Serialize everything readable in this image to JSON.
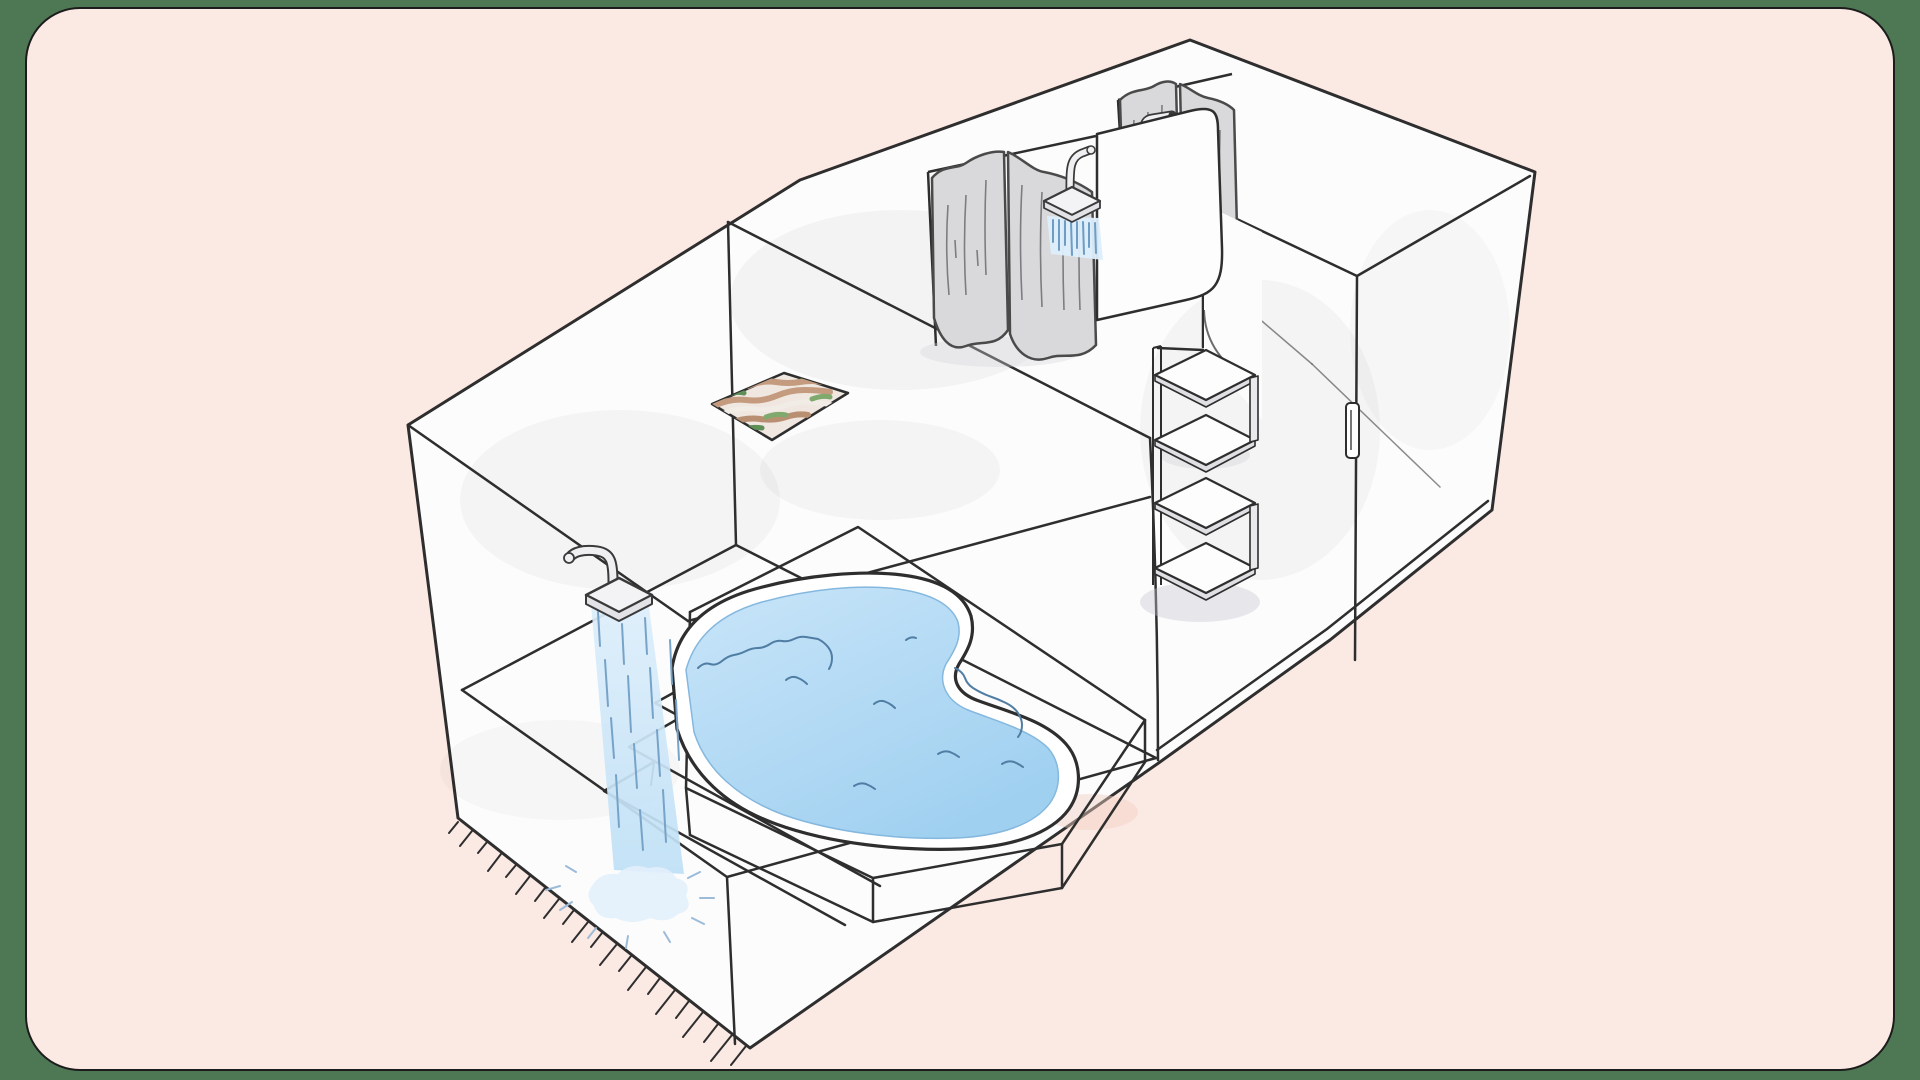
{
  "palette": {
    "outer_bg": "#4d7853",
    "card_bg": "#fbe9e4",
    "card_border": "#1c1c1c",
    "line": "#2e2e2e",
    "wall": "#fcfcfd",
    "water": "#9fd0f0",
    "water_light": "#c9e5f9",
    "water_edge": "#85b8de",
    "stream_top": "#ddeefb",
    "stream_bottom": "#bfe0f6",
    "stream_line": "#77a3c8",
    "wave_line": "#4f7da3",
    "splash_fill": "#e2f0fb",
    "splash_line": "#9cbbd8",
    "curtain_fill": "#d9d9db",
    "curtain_line": "#4a4a4a",
    "curtain_crease": "#7d7d80",
    "fixture_fill": "#f0f0f2",
    "fixture_face": "#f3f3f5",
    "fixture_lip": "#e3e3e7",
    "fixture_line": "#3a3a3a",
    "mat_fill": "#4e4e4e",
    "mosaic_tan": "#c49b7e",
    "mosaic_tan_dark": "#b98f72",
    "mosaic_white": "#f1ece6",
    "mosaic_green": "#5d8f57",
    "mosaic_olive": "#7fa96d",
    "shelf_side": "#e9e9ed",
    "shelf_lip": "#dfdfe4",
    "shadow": "#c9c9cf",
    "blush": "#f2cfc2"
  },
  "scene": {
    "type": "isometric-cutaway-illustration",
    "subject": "hand-drawn bathhouse floor plan with three rooms",
    "rooms": [
      {
        "name": "pool-room",
        "features": [
          "wall-mounted-overhead-shower",
          "falling-water-stream",
          "floor-splash",
          "three-corner-steps",
          "raised-deck",
          "free-form-blue-pool",
          "fringed-outer-edge"
        ]
      },
      {
        "name": "shower-room",
        "features": [
          "two-shower-stalls-with-gray-curtains",
          "two-overhead-shower-heads-spraying",
          "dark-bath-mat",
          "patterned-floor-mosaic",
          "four-tier-corner-shelf-unit",
          "doorway-with-door-handle"
        ]
      },
      {
        "name": "empty-room",
        "features": [
          "bare-walls"
        ]
      }
    ]
  }
}
